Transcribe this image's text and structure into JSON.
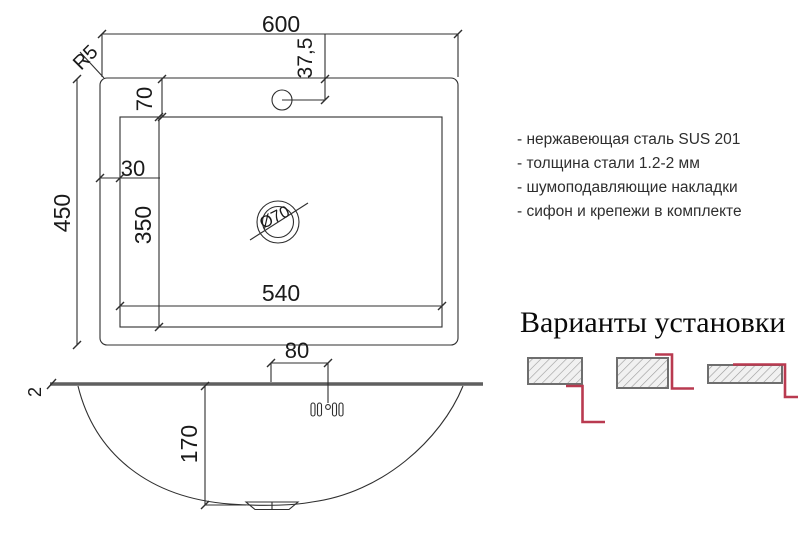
{
  "drawing": {
    "plan": {
      "dim_overall_width": "600",
      "dim_overall_depth": "450",
      "dim_bowl_width": "540",
      "dim_bowl_depth": "350",
      "dim_top_inset": "70",
      "dim_side_inset": "30",
      "dim_faucet_offset": "37,5",
      "corner_radius": "R5",
      "drain_diameter": "Ø70"
    },
    "side": {
      "dim_faucet_group": "80",
      "dim_bowl_height": "170",
      "dim_steel_thickness": "2"
    }
  },
  "specs": {
    "items": [
      "- нержавеющая сталь SUS 201",
      "- толщина стали 1.2-2 мм",
      "- шумоподавляющие накладки",
      "- сифон и крепежи в комплекте"
    ]
  },
  "installation": {
    "title": "Варианты установки",
    "variants": [
      "undermount",
      "flush-mount",
      "overmount"
    ]
  },
  "colors": {
    "line": "#2f2f2f",
    "rim": "#5f5f5f",
    "accent_red": "#b93a50",
    "hatch_fill": "#f1f1f1",
    "hatch_line": "#9a9a9a",
    "hatch_border": "#6e6e6e"
  }
}
